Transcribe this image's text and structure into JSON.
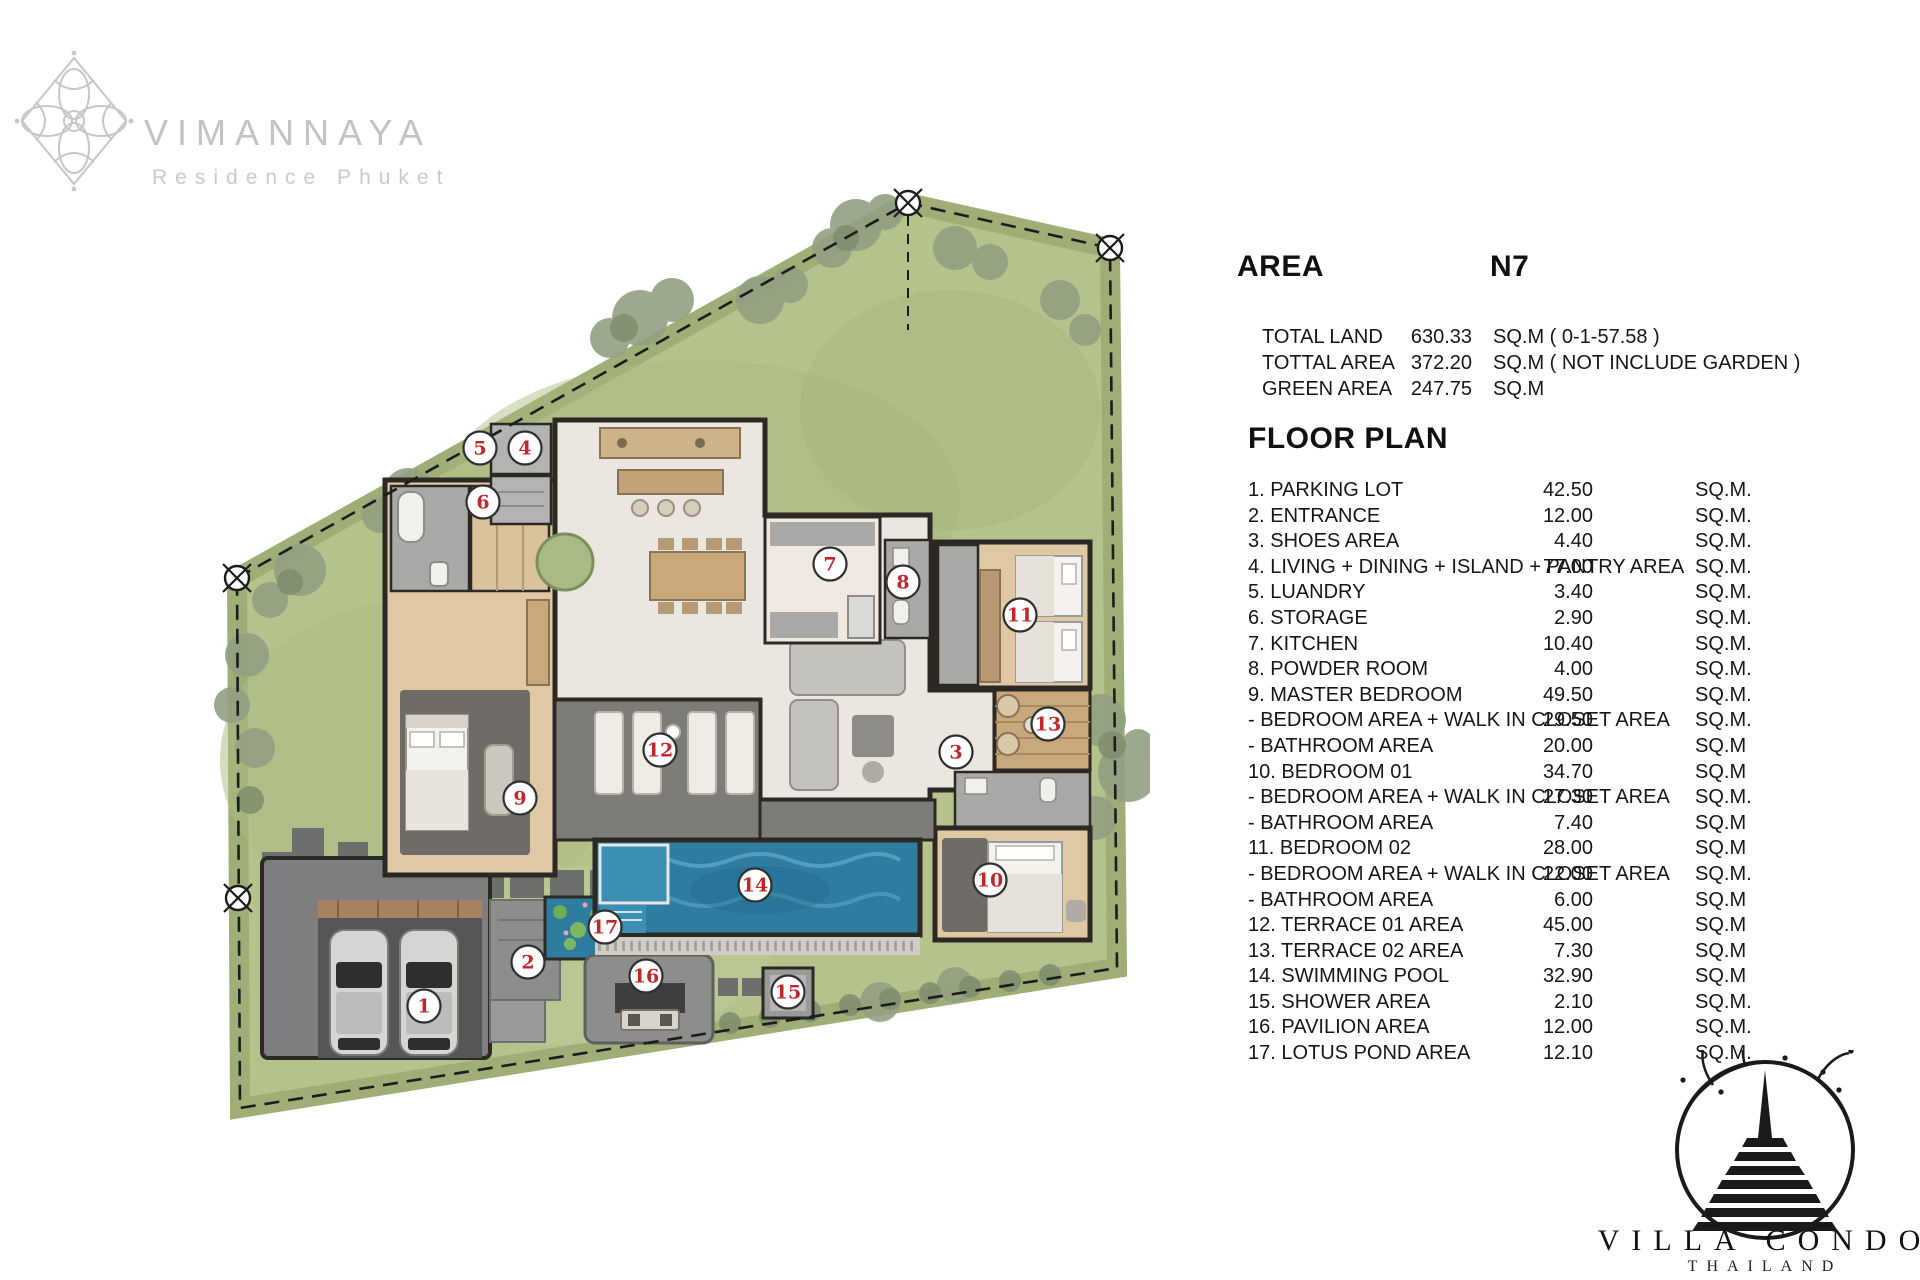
{
  "branding": {
    "name": "VIMANNAYA",
    "subtitle": "Residence Phuket"
  },
  "area_panel": {
    "title": "AREA",
    "code": "N7",
    "rows": [
      {
        "label": "TOTAL LAND",
        "value": "630.33",
        "unit": "SQ.M ( 0-1-57.58 )"
      },
      {
        "label": "TOTTAL AREA",
        "value": "372.20",
        "unit": "SQ.M ( NOT INCLUDE GARDEN )"
      },
      {
        "label": "GREEN AREA",
        "value": "247.75",
        "unit": "SQ.M"
      }
    ]
  },
  "floor_plan": {
    "title": "FLOOR PLAN",
    "rows": [
      {
        "label": "1.  PARKING LOT",
        "value": "42.50",
        "unit": "SQ.M."
      },
      {
        "label": "2.  ENTRANCE",
        "value": "12.00",
        "unit": "SQ.M."
      },
      {
        "label": "3.  SHOES AREA",
        "value": "4.40",
        "unit": "SQ.M."
      },
      {
        "label": "4.  LIVING + DINING + ISLAND + PANTRY AREA",
        "value": "77.00",
        "unit": "SQ.M."
      },
      {
        "label": "5.  LUANDRY",
        "value": "3.40",
        "unit": "SQ.M."
      },
      {
        "label": "6.  STORAGE",
        "value": "2.90",
        "unit": "SQ.M."
      },
      {
        "label": "7.  KITCHEN",
        "value": "10.40",
        "unit": "SQ.M."
      },
      {
        "label": "8.  POWDER ROOM",
        "value": "4.00",
        "unit": "SQ.M."
      },
      {
        "label": "9.  MASTER BEDROOM",
        "value": "49.50",
        "unit": "SQ.M."
      },
      {
        "label": "-  BEDROOM AREA  + WALK IN CLOSET AREA",
        "value": "29.50",
        "unit": "SQ.M."
      },
      {
        "label": "-  BATHROOM AREA",
        "value": "20.00",
        "unit": "SQ.M"
      },
      {
        "label": "10. BEDROOM 01",
        "value": "34.70",
        "unit": "SQ.M"
      },
      {
        "label": "-  BEDROOM AREA + WALK IN CLOSET AREA",
        "value": "27.30",
        "unit": "SQ.M."
      },
      {
        "label": "-  BATHROOM AREA",
        "value": "7.40",
        "unit": "SQ.M"
      },
      {
        "label": "11. BEDROOM  02",
        "value": "28.00",
        "unit": "SQ.M"
      },
      {
        "label": "-  BEDROOM AREA + WALK IN CLOSET AREA",
        "value": "22.00",
        "unit": "SQ.M."
      },
      {
        "label": "-  BATHROOM AREA",
        "value": "6.00",
        "unit": "SQ.M"
      },
      {
        "label": "12. TERRACE  01  AREA",
        "value": "45.00",
        "unit": "SQ.M"
      },
      {
        "label": "13. TERRACE  02  AREA",
        "value": "7.30",
        "unit": "SQ.M"
      },
      {
        "label": "14. SWIMMING POOL",
        "value": "32.90",
        "unit": "SQ.M"
      },
      {
        "label": "15. SHOWER AREA",
        "value": "2.10",
        "unit": "SQ.M."
      },
      {
        "label": "16. PAVILION AREA",
        "value": "12.00",
        "unit": "SQ.M."
      },
      {
        "label": "17. LOTUS POND AREA",
        "value": "12.10",
        "unit": "SQ.M."
      }
    ]
  },
  "footer_logo": {
    "name": "VILLA CONDO",
    "country": "THAILAND"
  },
  "plan": {
    "labels": [
      {
        "n": "1",
        "x": 424,
        "y": 1006
      },
      {
        "n": "2",
        "x": 528,
        "y": 962
      },
      {
        "n": "3",
        "x": 956,
        "y": 752
      },
      {
        "n": "4",
        "x": 525,
        "y": 448
      },
      {
        "n": "5",
        "x": 480,
        "y": 448
      },
      {
        "n": "6",
        "x": 483,
        "y": 502
      },
      {
        "n": "7",
        "x": 830,
        "y": 564
      },
      {
        "n": "8",
        "x": 903,
        "y": 582
      },
      {
        "n": "9",
        "x": 520,
        "y": 798
      },
      {
        "n": "10",
        "x": 990,
        "y": 880
      },
      {
        "n": "11",
        "x": 1020,
        "y": 615
      },
      {
        "n": "12",
        "x": 660,
        "y": 750
      },
      {
        "n": "13",
        "x": 1048,
        "y": 724
      },
      {
        "n": "14",
        "x": 755,
        "y": 885
      },
      {
        "n": "15",
        "x": 788,
        "y": 992
      },
      {
        "n": "16",
        "x": 646,
        "y": 976
      },
      {
        "n": "17",
        "x": 605,
        "y": 927
      }
    ]
  }
}
